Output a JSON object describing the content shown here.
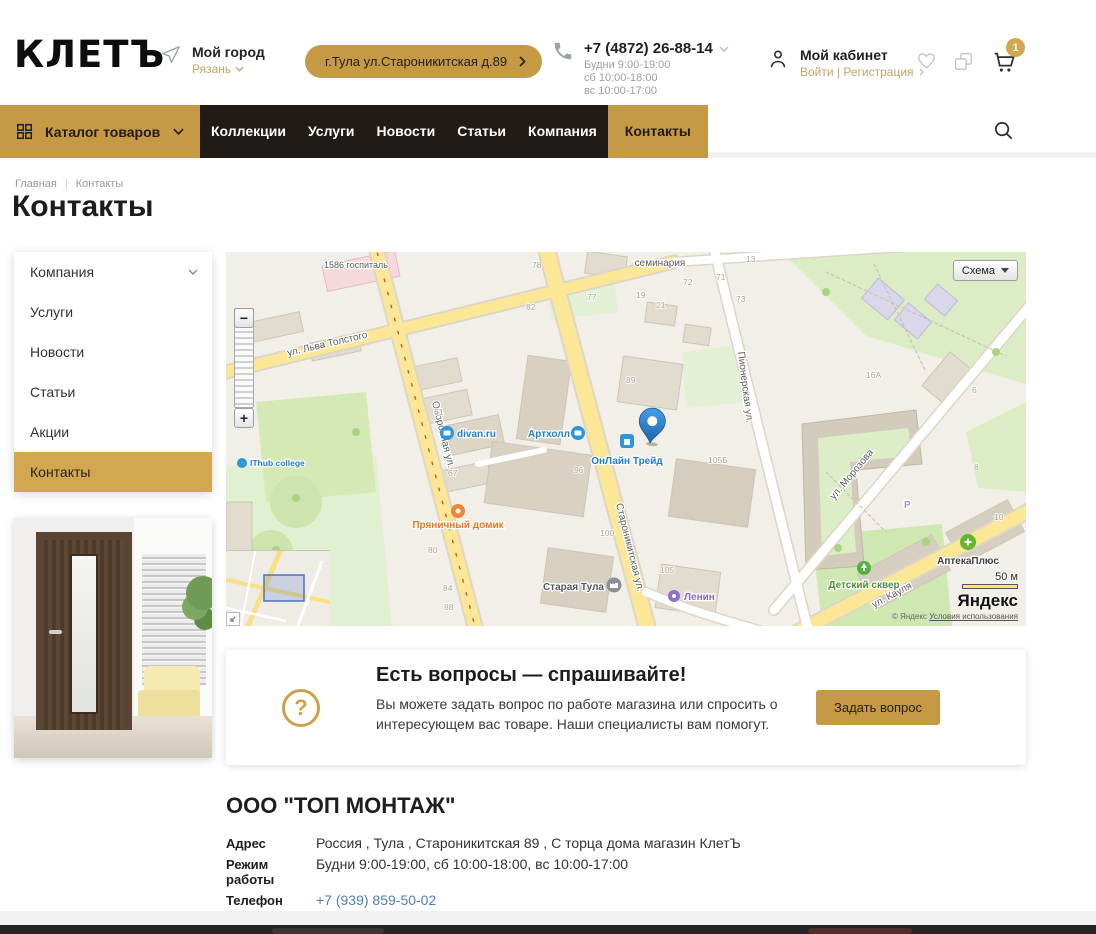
{
  "header": {
    "logo": "КЛЕТЪ",
    "city": {
      "label": "Мой город",
      "value": "Рязань"
    },
    "address_button": "г.Тула ул.Староникитская д.89",
    "phone": {
      "number": "+7 (4872) 26-88-14",
      "hours": [
        "Будни 9:00-19:00",
        "сб 10:00-18:00",
        "вс 10:00-17:00"
      ]
    },
    "account": {
      "label": "Мой кабинет",
      "sub": "Войти | Регистрация"
    },
    "cart_count": "1"
  },
  "nav": {
    "catalog_label": "Каталог товаров",
    "items": [
      "Коллекции",
      "Услуги",
      "Новости",
      "Статьи",
      "Компания"
    ],
    "active_item": "Контакты"
  },
  "breadcrumb": {
    "items": [
      "Главная",
      "Контакты"
    ],
    "separator": "|"
  },
  "page_title": "Контакты",
  "sidebar": {
    "items": [
      "Компания",
      "Услуги",
      "Новости",
      "Статьи",
      "Акции",
      "Контакты"
    ]
  },
  "map": {
    "layer_button": "Схема",
    "zoom_out": "−",
    "zoom_in": "+",
    "scale_label": "50 м",
    "provider_logo": "Яндекс",
    "copyright": "© Яндекс",
    "terms": "Условия использования",
    "parking": "P",
    "streets": [
      "ул. Льва Толстого",
      "Оборонная ул.",
      "Староникитская ул.",
      "Пионерская ул.",
      "ул. Морозова",
      "ул. Кауля"
    ],
    "pois": [
      "divan.ru",
      "Артхолл",
      "ОнЛайн Трейд",
      "IThub college",
      "Пряничный домик",
      "Старая Тула",
      "Ленин",
      "АптекаПлюс",
      "Детский сквер",
      "семинария",
      "1586 госпиталь"
    ],
    "houses": [
      "78",
      "77",
      "82",
      "19",
      "21",
      "72",
      "71",
      "73",
      "13",
      "6",
      "8",
      "10",
      "16А",
      "89",
      "96",
      "100",
      "105",
      "105Б",
      "80",
      "84",
      "88",
      "61",
      "67"
    ]
  },
  "question_card": {
    "title": "Есть вопросы — спрашивайте!",
    "text": "Вы можете задать вопрос по работе магазина или спросить о интересующем вас товаре. Наши специалисты вам помогут.",
    "question_mark": "?",
    "button": "Задать вопрос"
  },
  "company": {
    "name": "ООО \"ТОП МОНТАЖ\"",
    "rows": [
      {
        "label": "Адрес",
        "value": "Россия , Тула , Староникитская 89 , С торца дома магазин КлетЪ"
      },
      {
        "label": "Режим работы",
        "value": "Будни 9:00-19:00, сб 10:00-18:00, вс 10:00-17:00"
      },
      {
        "label": "Телефон",
        "value": "+7 (939) 859-50-02"
      },
      {
        "label": "Почта",
        "value": "info@klet-tula.ru"
      }
    ]
  },
  "colors": {
    "accent": "#c69a44",
    "nav_bg": "#201b16",
    "link_blue": "#4d7fb5"
  }
}
